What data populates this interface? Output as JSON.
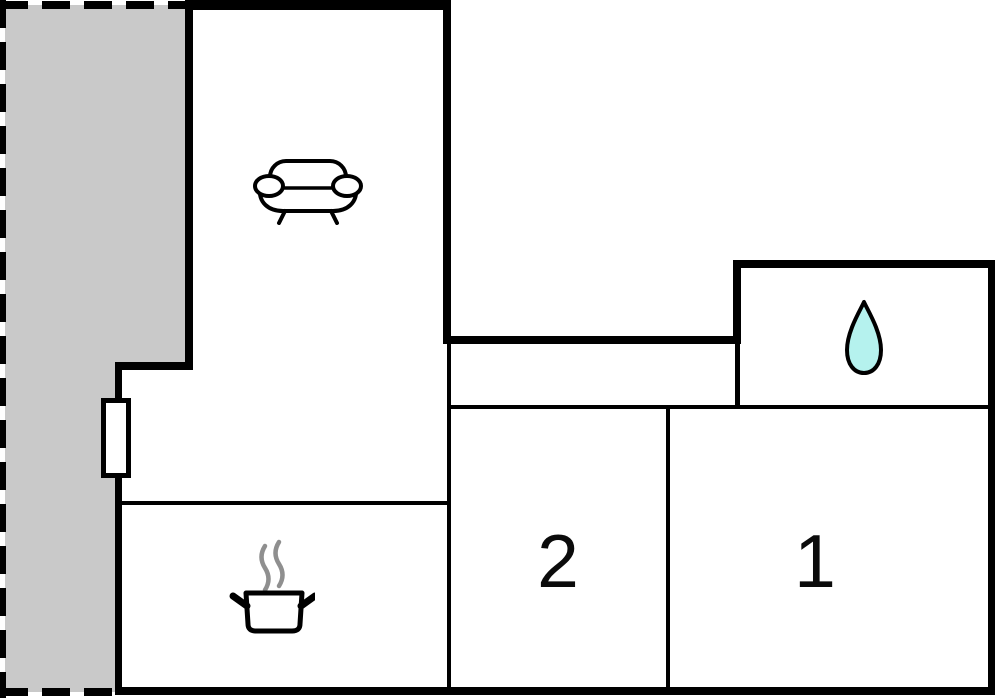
{
  "floorplan": {
    "rooms": {
      "bedroom_1": {
        "label": "1"
      },
      "bedroom_2": {
        "label": "2"
      },
      "living_room": {
        "icon": "sofa-icon"
      },
      "kitchen": {
        "icon": "cooking-pot-icon"
      },
      "bathroom": {
        "icon": "water-drop-icon"
      }
    }
  },
  "colors": {
    "wall": "#000000",
    "terrace-fill": "#c9c9c9",
    "drop-fill": "#b5f2ee",
    "steam": "#8f8f8f",
    "background": "#ffffff",
    "label-text": "#0b0b0b"
  }
}
